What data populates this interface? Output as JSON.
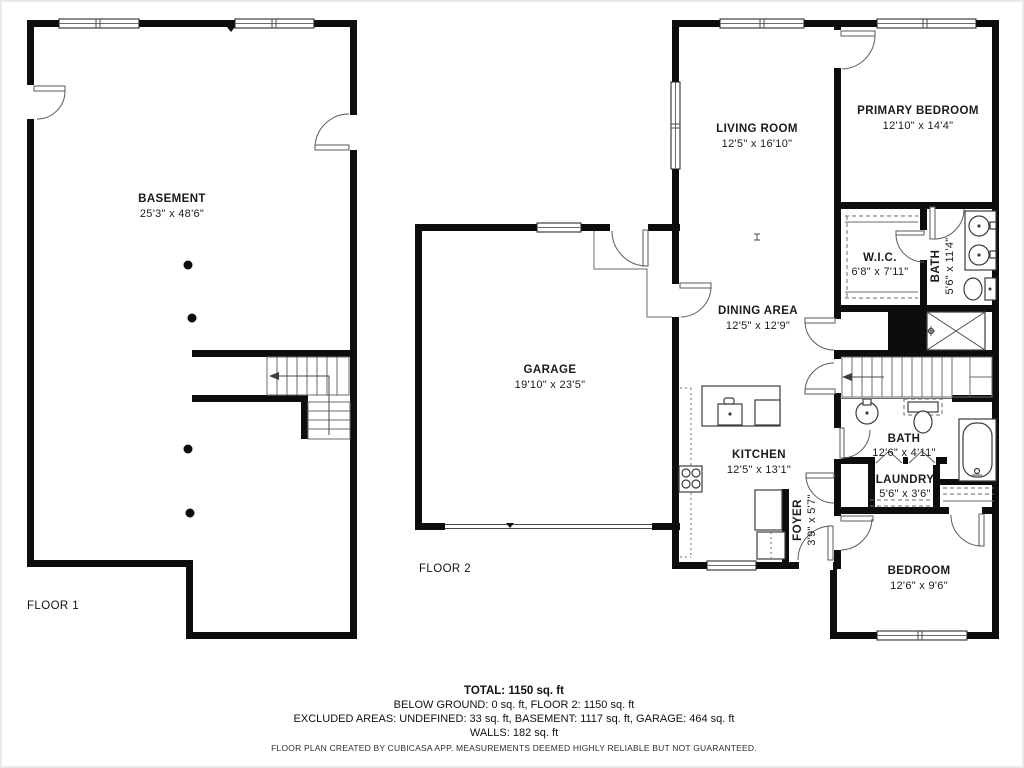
{
  "colors": {
    "wall": "#0d0d0d",
    "line": "#5a5a5a",
    "text": "#1b1b1b",
    "background": "#ffffff"
  },
  "floor1": {
    "label": "FLOOR 1",
    "rooms": {
      "basement": {
        "name": "BASEMENT",
        "dims": "25'3\" x 48'6\""
      }
    }
  },
  "floor2": {
    "label": "FLOOR 2",
    "rooms": {
      "living": {
        "name": "LIVING ROOM",
        "dims": "12'5\" x 16'10\""
      },
      "primary_bedroom": {
        "name": "PRIMARY BEDROOM",
        "dims": "12'10\" x 14'4\""
      },
      "wic": {
        "name": "W.I.C.",
        "dims": "6'8\" x 7'11\""
      },
      "primary_bath": {
        "name": "BATH",
        "dims": "5'6\" x 11'4\""
      },
      "dining": {
        "name": "DINING AREA",
        "dims": "12'5\" x 12'9\""
      },
      "garage": {
        "name": "GARAGE",
        "dims": "19'10\" x 23'5\""
      },
      "kitchen": {
        "name": "KITCHEN",
        "dims": "12'5\" x 13'1\""
      },
      "foyer": {
        "name": "FOYER",
        "dims": "3'9\" x 5'7\""
      },
      "bath": {
        "name": "BATH",
        "dims": "12'6\" x 4'11\""
      },
      "laundry": {
        "name": "LAUNDRY",
        "dims": "5'6\" x 3'6\""
      },
      "bedroom": {
        "name": "BEDROOM",
        "dims": "12'6\" x 9'6\""
      }
    }
  },
  "summary": {
    "total": "TOTAL: 1150 sq. ft",
    "line1": "BELOW GROUND: 0 sq. ft, FLOOR 2: 1150 sq. ft",
    "line2": "EXCLUDED AREAS: UNDEFINED: 33 sq. ft, BASEMENT: 1117 sq. ft, GARAGE: 464 sq. ft",
    "line3": "WALLS: 182 sq. ft",
    "disclaimer": "FLOOR PLAN CREATED BY CUBICASA APP. MEASUREMENTS DEEMED HIGHLY RELIABLE BUT NOT GUARANTEED."
  }
}
